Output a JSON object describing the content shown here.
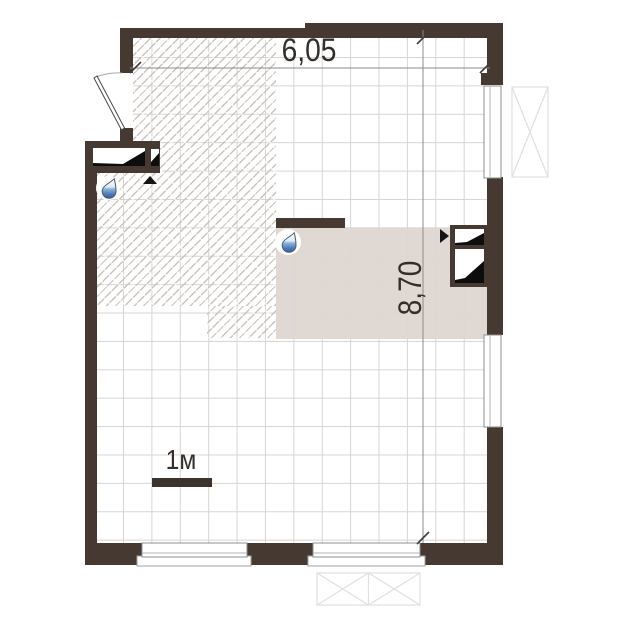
{
  "plan": {
    "type": "apartment-floor-plan",
    "width_label": "6,05",
    "height_label": "8,70",
    "scale_label": "1м",
    "icons": {
      "water_drop": "water-supply-point-icon",
      "vent_shaft": "ventilation-shaft-icon",
      "door": "entry-door-swing",
      "window": "window-symbol",
      "balcony": "balcony-glazing-symbol"
    },
    "colors": {
      "wall": "#453931",
      "wet_zone_fill": "#ded7d0",
      "hatch_line": "#ccc3bb",
      "grid_line": "#d7d5d3",
      "dimension_text": "#332e29",
      "drop_blue": "#3f6fae"
    }
  }
}
